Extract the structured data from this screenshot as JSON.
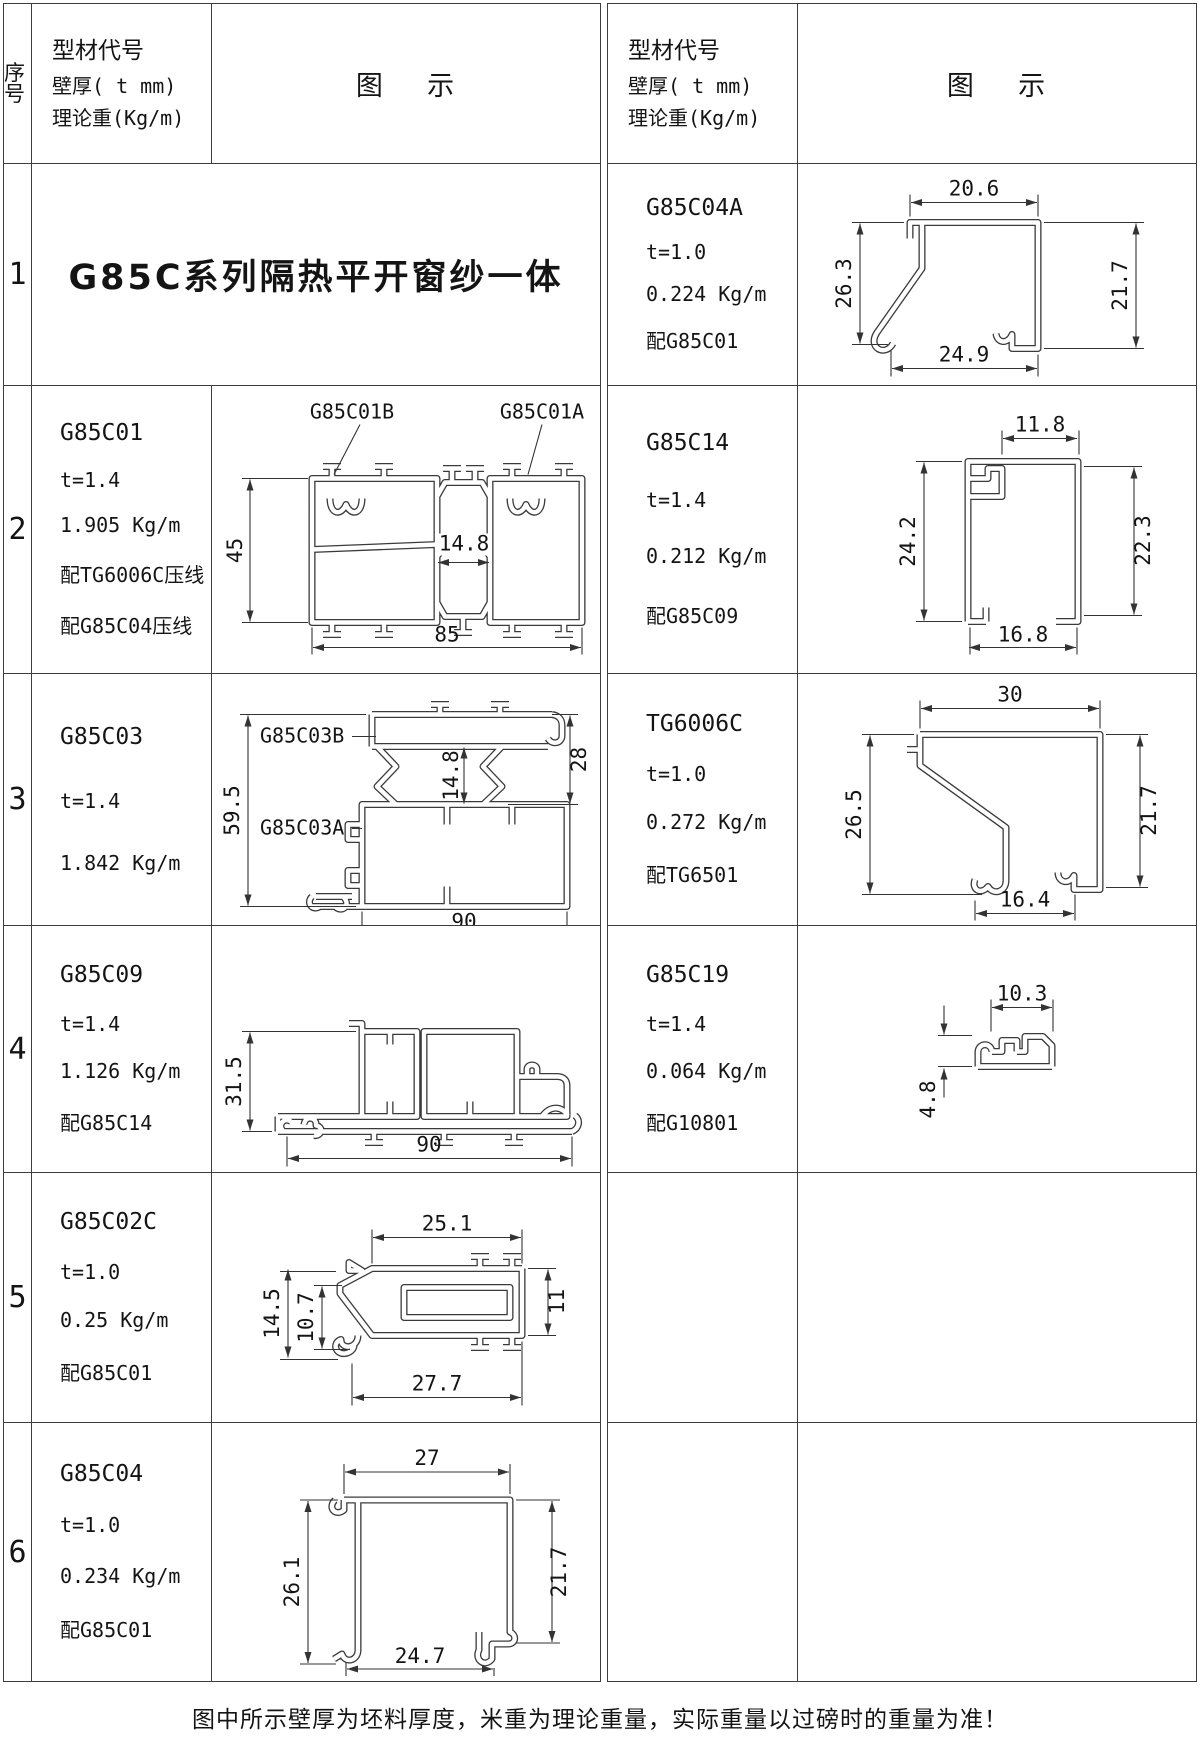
{
  "page": {
    "footer": "图中所示壁厚为坯料厚度，米重为理论重量，实际重量以过磅时的重量为准！",
    "line_color": "#3d3d3d",
    "background": "#ffffff"
  },
  "header": {
    "seq": "序号",
    "info_lines": [
      "型材代号",
      "壁厚( t mm)",
      "理论重(Kg/m)"
    ],
    "diagram": "图    示"
  },
  "series_title": "G85C系列隔热平开窗纱一体",
  "rows": [
    {
      "num": "1",
      "right": {
        "lines": [
          "G85C04A",
          "t=1.0",
          "0.224 Kg/m",
          "配G85C01"
        ],
        "dims": {
          "top": "20.6",
          "left": "26.3",
          "right": "21.7",
          "bottom": "24.9"
        }
      }
    },
    {
      "num": "2",
      "left": {
        "lines": [
          "G85C01",
          "t=1.4",
          "1.905 Kg/m",
          "配TG6006C压线",
          "配G85C04压线"
        ],
        "dims": {
          "label_b": "G85C01B",
          "label_a": "G85C01A",
          "height": "45",
          "break": "14.8",
          "width": "85"
        }
      },
      "right": {
        "lines": [
          "G85C14",
          "t=1.4",
          "0.212 Kg/m",
          "配G85C09"
        ],
        "dims": {
          "top": "11.8",
          "left": "24.2",
          "right": "22.3",
          "bottom": "16.8"
        }
      }
    },
    {
      "num": "3",
      "left": {
        "lines": [
          "G85C03",
          "t=1.4",
          "1.842 Kg/m"
        ],
        "dims": {
          "label_b": "G85C03B",
          "label_a": "G85C03A",
          "height": "59.5",
          "break": "14.8",
          "right": "28",
          "width": "90"
        }
      },
      "right": {
        "lines": [
          "TG6006C",
          "t=1.0",
          "0.272 Kg/m",
          "配TG6501"
        ],
        "dims": {
          "top": "30",
          "left": "26.5",
          "right": "21.7",
          "bottom": "16.4"
        }
      }
    },
    {
      "num": "4",
      "left": {
        "lines": [
          "G85C09",
          "t=1.4",
          "1.126 Kg/m",
          "配G85C14"
        ],
        "dims": {
          "height": "31.5",
          "width": "90"
        }
      },
      "right": {
        "lines": [
          "G85C19",
          "t=1.4",
          "0.064 Kg/m",
          "配G10801"
        ],
        "dims": {
          "top": "10.3",
          "left": "4.8"
        }
      }
    },
    {
      "num": "5",
      "left": {
        "lines": [
          "G85C02C",
          "t=1.0",
          "0.25 Kg/m",
          "配G85C01"
        ],
        "dims": {
          "top": "25.1",
          "left": "14.5",
          "inner": "10.7",
          "right": "11",
          "bottom": "27.7"
        }
      }
    },
    {
      "num": "6",
      "left": {
        "lines": [
          "G85C04",
          "t=1.0",
          "0.234 Kg/m",
          "配G85C01"
        ],
        "dims": {
          "top": "27",
          "left": "26.1",
          "right": "21.7",
          "bottom": "24.7"
        }
      }
    }
  ]
}
